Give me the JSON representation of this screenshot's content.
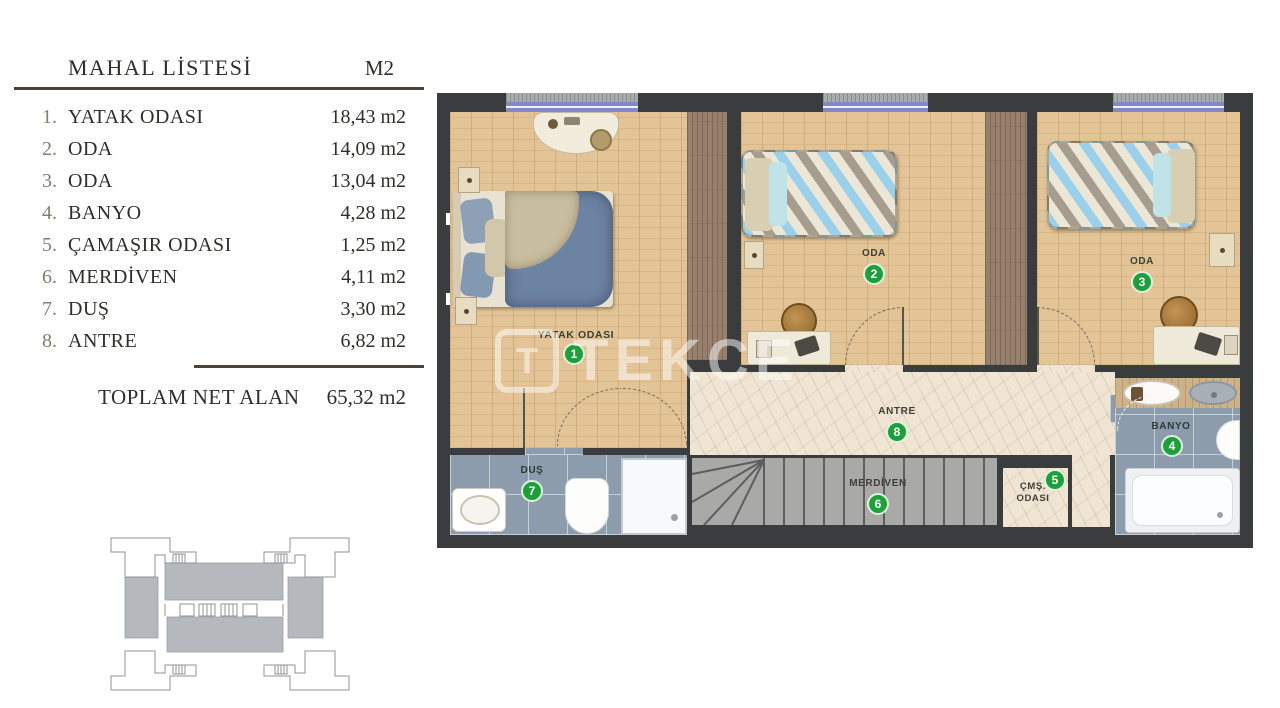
{
  "palette": {
    "wall": "#3b3c3e",
    "wood": "#e3c496",
    "wardrobe": "#97816e",
    "marble": "#efe5d2",
    "bathroom_tile": "#8c9cac",
    "stairs": "#a9a9a7",
    "badge_green": "#1da03c",
    "window_purple": "#8488cb",
    "rule_brown": "#4c4138",
    "table_text": "#2f2e2a",
    "row_number_green": "#76856f",
    "keyplan_fill": "#b5b9be"
  },
  "table": {
    "title": "MAHAL LİSTESİ",
    "unit_header": "M2",
    "rows": [
      {
        "num": "1.",
        "label": "YATAK ODASI",
        "area": "18,43 m2"
      },
      {
        "num": "2.",
        "label": "ODA",
        "area": "14,09 m2"
      },
      {
        "num": "3.",
        "label": "ODA",
        "area": "13,04 m2"
      },
      {
        "num": "4.",
        "label": "BANYO",
        "area": "4,28 m2"
      },
      {
        "num": "5.",
        "label": "ÇAMAŞIR ODASI",
        "area": "1,25 m2"
      },
      {
        "num": "6.",
        "label": "MERDİVEN",
        "area": "4,11 m2"
      },
      {
        "num": "7.",
        "label": "DUŞ",
        "area": "3,30 m2"
      },
      {
        "num": "8.",
        "label": "ANTRE",
        "area": "6,82 m2"
      }
    ],
    "total_label": "TOPLAM NET ALAN",
    "total_value": "65,32 m2"
  },
  "plan": {
    "watermark_logo": "T",
    "watermark": "TEKCE",
    "rooms": [
      {
        "num": "1",
        "label": "YATAK ODASI"
      },
      {
        "num": "2",
        "label": "ODA"
      },
      {
        "num": "3",
        "label": "ODA"
      },
      {
        "num": "4",
        "label": "BANYO"
      },
      {
        "num": "5",
        "label": "ÇMŞ. ODASI"
      },
      {
        "num": "6",
        "label": "MERDİVEN"
      },
      {
        "num": "7",
        "label": "DUŞ"
      },
      {
        "num": "8",
        "label": "ANTRE"
      }
    ]
  }
}
